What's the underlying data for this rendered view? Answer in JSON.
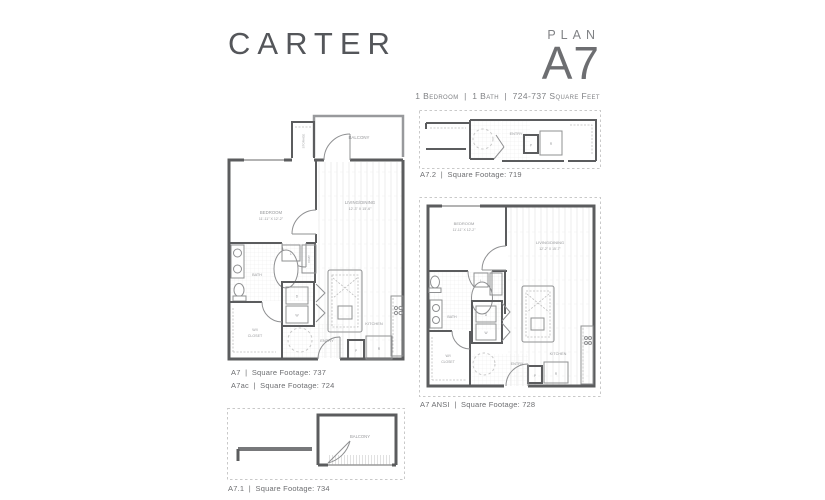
{
  "header": {
    "property_name": "CARTER",
    "plan_kicker": "PLAN",
    "plan_name": "A7",
    "summary": "1 Bedroom  |  1 Bath  |  724-737 Square Feet"
  },
  "captions": {
    "a7": "A7  |  Square Footage: 737",
    "a7ac": "A7ac  |  Square Footage: 724",
    "a72": "A7.2  |  Square Footage: 719",
    "ansi": "A7 ANSI  |  Square Footage: 728",
    "a71": "A7.1  |  Square Footage: 734"
  },
  "rooms": {
    "balcony": "BALCONY",
    "storage": "STORAGE",
    "bedroom": "BEDROOM",
    "bedroom_dims": "11'-11\" X 12'-2\"",
    "living": "LIVING/DINING",
    "living_dims_main": "12'-3\" X 15'-6\"",
    "living_dims_ansi": "12'-2\" X 15'-7\"",
    "bath": "BATH",
    "wi": "W/I",
    "closet": "CLOSET",
    "kitchen": "KITCHEN",
    "entry": "ENTRY",
    "coat": "COAT",
    "linen": "L",
    "dryer": "D",
    "washer": "W",
    "pantry": "P",
    "refrigerator": "R"
  },
  "colors": {
    "wall": "#5b5c5e",
    "fixture": "#8f9092",
    "label": "#97989b",
    "caption": "#6d6e71",
    "hatch": "#e7e7e7",
    "variant_border": "#c9c9c9"
  }
}
